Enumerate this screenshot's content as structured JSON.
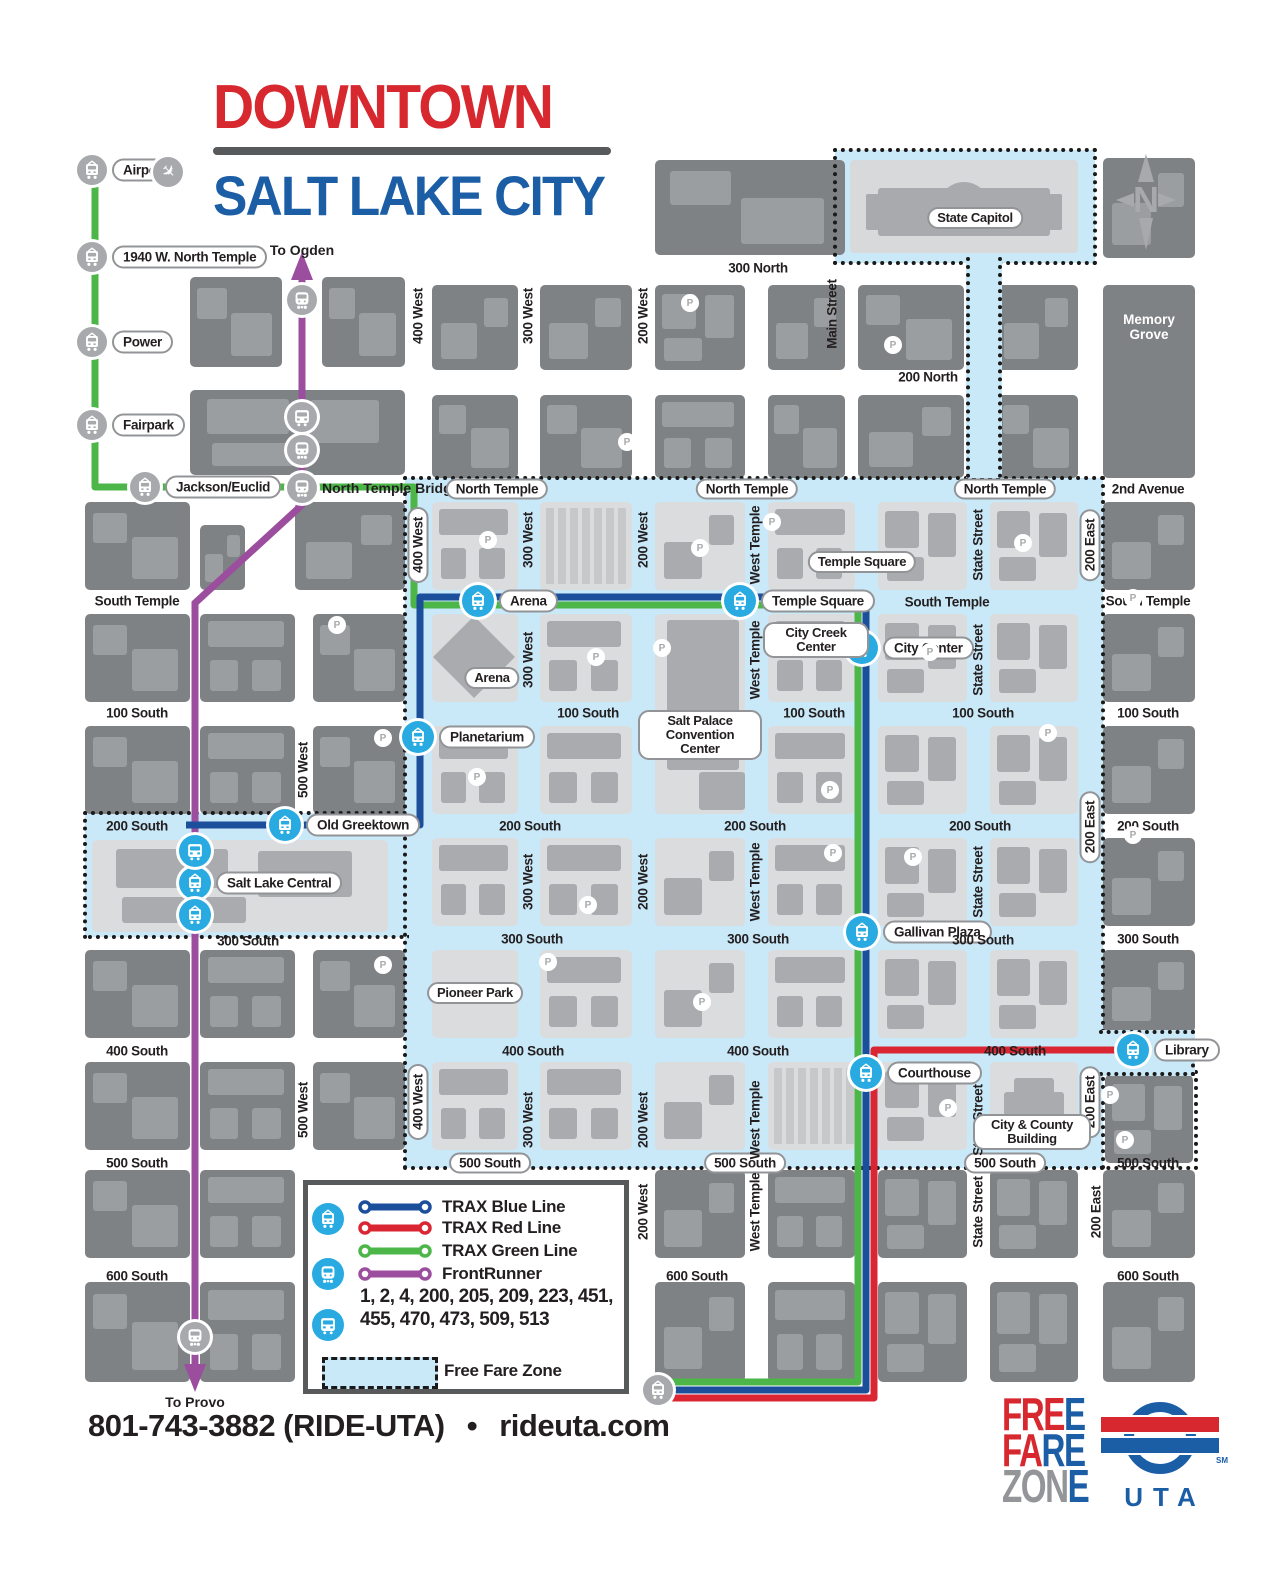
{
  "title": {
    "line1": "DOWNTOWN",
    "line2": "SALT LAKE CITY"
  },
  "compass": {
    "label": "N"
  },
  "directions": {
    "north": "To Ogden",
    "south": "To Provo"
  },
  "streets": {
    "horizontal": [
      "300 North",
      "200 North",
      "North Temple",
      "2nd Avenue",
      "South Temple",
      "100 South",
      "200 South",
      "300 South",
      "400 South",
      "500 South",
      "600 South"
    ],
    "vertical": [
      "400 West",
      "500 West",
      "300 West",
      "200 West",
      "West Temple",
      "Main Street",
      "State Street",
      "200 East"
    ]
  },
  "stations": {
    "gray": [
      "Airport",
      "1940 W. North Temple",
      "Power",
      "Fairpark",
      "Jackson/Euclid",
      "North Temple Bridge"
    ],
    "blue": [
      "Arena",
      "Temple Square",
      "City Center",
      "Planetarium",
      "Old Greektown",
      "Salt Lake Central",
      "Gallivan Plaza",
      "Courthouse",
      "Library"
    ]
  },
  "pois": [
    "State Capitol",
    "Memory Grove",
    "Temple Square",
    "City Creek Center",
    "Arena",
    "Salt Palace Convention Center",
    "Pioneer Park",
    "City & County Building"
  ],
  "legend": {
    "lines": [
      {
        "label": "TRAX Blue Line",
        "color": "#1B4E9B"
      },
      {
        "label": "TRAX Red Line",
        "color": "#D92632"
      },
      {
        "label": "TRAX Green Line",
        "color": "#4DB648"
      },
      {
        "label": "FrontRunner",
        "color": "#9C4E9E"
      }
    ],
    "bus_routes": "1, 2, 4, 200, 205, 209, 223, 451, 455, 470, 473, 509, 513",
    "free_fare": "Free Fare Zone"
  },
  "footer": {
    "phone": "801-743-3882 (RIDE-UTA)",
    "separator": "•",
    "website": "rideuta.com"
  },
  "logos": {
    "ffz_lines": [
      "FREE",
      "FARE",
      "ZONE"
    ],
    "uta": "UTA",
    "uta_sm": "SM"
  },
  "colors": {
    "zone": "#C9E8F8",
    "blue_line": "#1B4E9B",
    "red_line": "#D92632",
    "green_line": "#4DB648",
    "frontrunner": "#9C4E9E",
    "station_blue": "#29ABE2",
    "title_red": "#D7282F",
    "title_blue": "#1B5EA6"
  }
}
